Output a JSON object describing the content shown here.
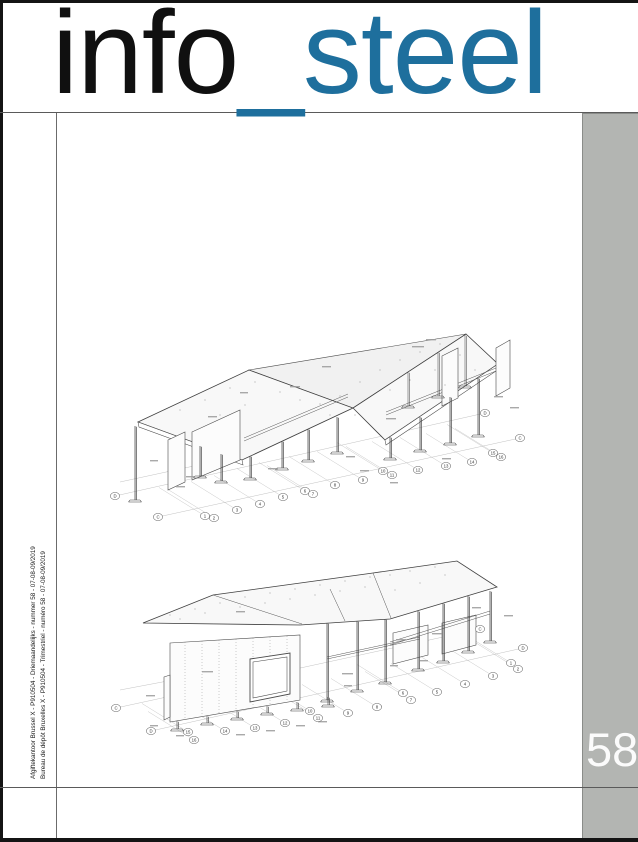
{
  "masthead": {
    "black": "info",
    "accent": "_steel"
  },
  "issue_number": "58",
  "imprint": {
    "line1": "Afgiftekantoor Brussel X - P910504 - Driemaandelijks - nummer 58 - 07-08-09/2019",
    "line2": "Bureau de dépôt Bruxelles X - P910504 - Trimestriel - numéro 58 - 07-08-09/2019"
  },
  "colors": {
    "accent_blue": "#1e6f9d",
    "sidebar_gray": "#b3b5b2"
  },
  "drawings": {
    "top": {
      "grid_letters": {
        "left_d": "D",
        "left_c": "C",
        "right_c": "C",
        "right_d": "D"
      },
      "grid_numbers": [
        "1",
        "2",
        "3",
        "4",
        "5",
        "6",
        "7",
        "8",
        "9",
        "10",
        "11",
        "12",
        "13",
        "14",
        "15",
        "16"
      ]
    },
    "bottom": {
      "grid_letters": {
        "left_c": "C",
        "left_d": "D",
        "right_c": "C",
        "right_d": "D"
      },
      "grid_numbers": [
        "1",
        "2",
        "3",
        "4",
        "5",
        "6",
        "7",
        "8",
        "9",
        "10",
        "11",
        "12",
        "13",
        "14",
        "15",
        "16"
      ]
    }
  }
}
